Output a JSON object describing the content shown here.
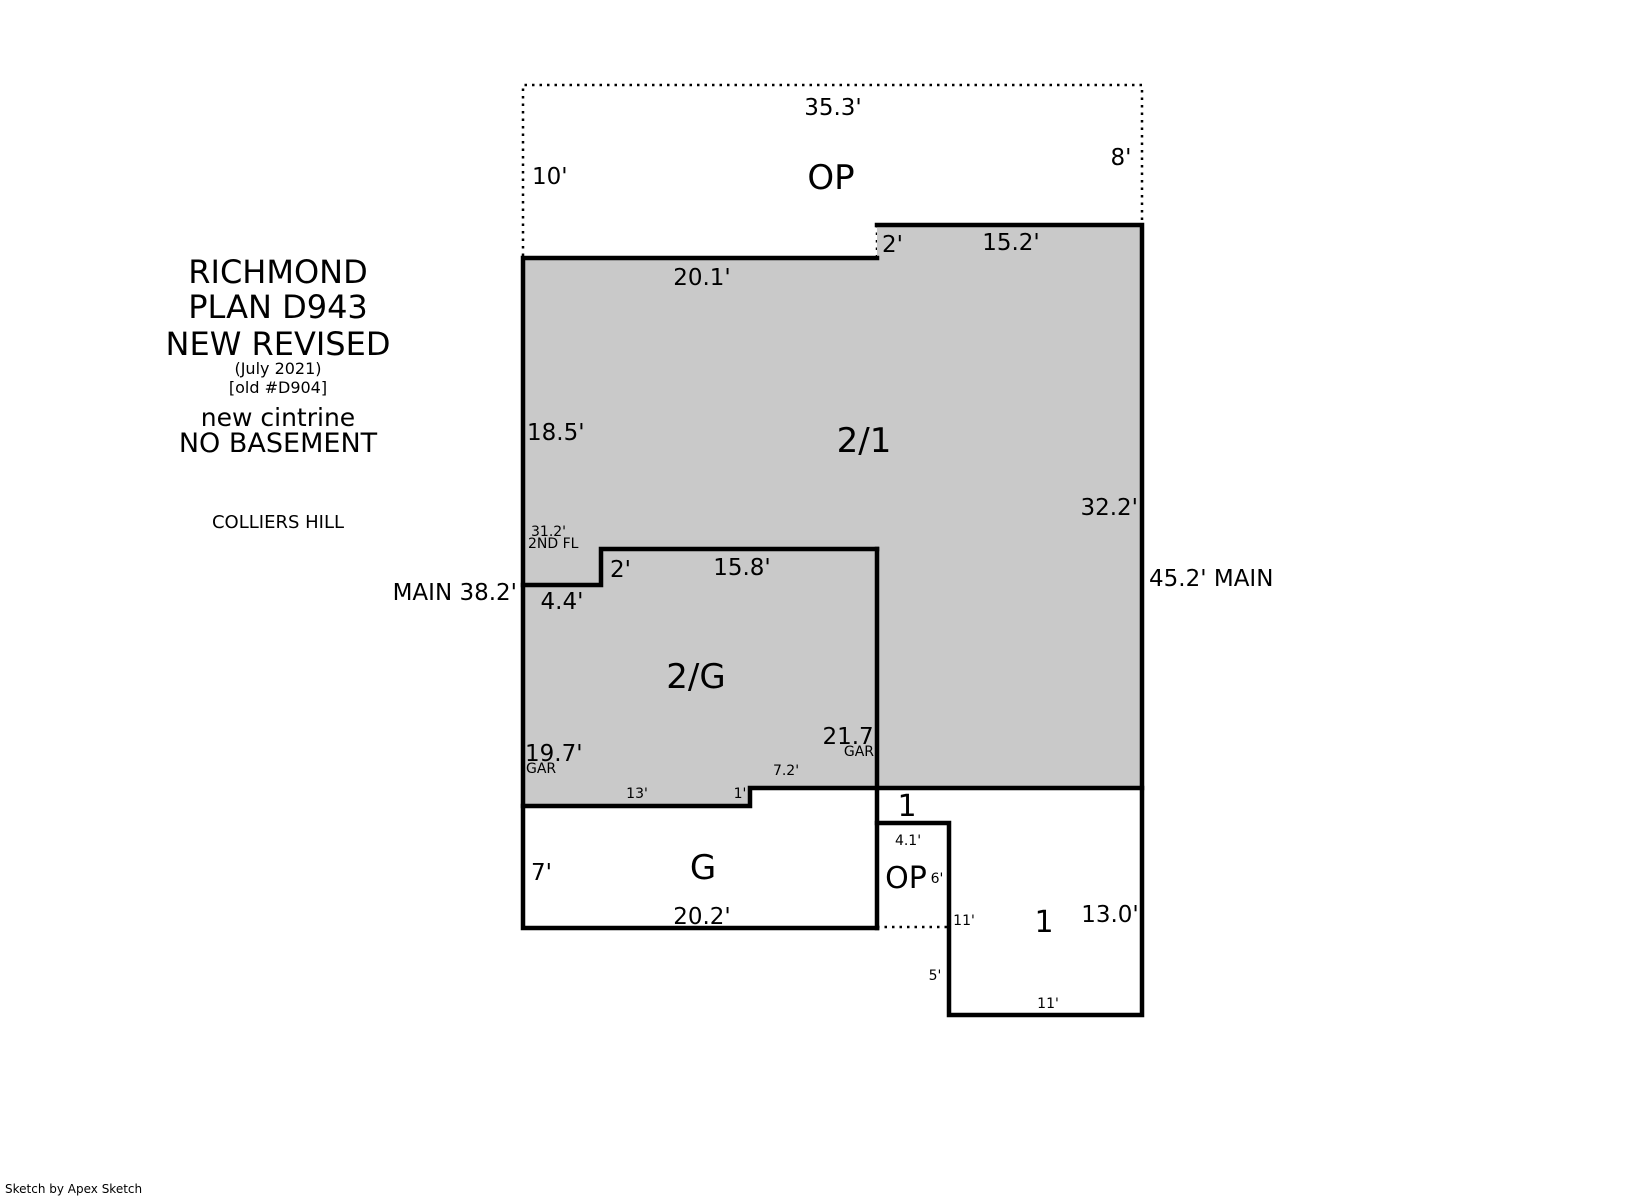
{
  "title_block": {
    "model": "RICHMOND",
    "plan": "PLAN D943",
    "revision": "NEW REVISED",
    "revision_date": "(July 2021)",
    "old_plan": "[old #D904]",
    "note1": "new cintrine",
    "note2": "NO BASEMENT",
    "subdivision": "COLLIERS HILL"
  },
  "area_labels": {
    "open_porch_top": "OP",
    "two_story_over_one": "2/1",
    "two_story_over_garage": "2/G",
    "garage": "G",
    "one_story_strip": "1",
    "open_porch_bottom": "OP",
    "one_story_room": "1"
  },
  "dimensions": {
    "op_top_width": "35.3'",
    "op_left_depth": "10'",
    "op_right_depth": "8'",
    "front_wall_left": "20.1'",
    "front_wall_step": "2'",
    "front_wall_right": "15.2'",
    "left_wall_upper": "18.5'",
    "left_wall_2nd_fl": "31.2'",
    "left_wall_2nd_fl_note": "2ND FL",
    "left_wall_main": "MAIN 38.2'",
    "garage_step_in": "4.4'",
    "garage_step_up": "2'",
    "garage_top_width": "15.8'",
    "right_wall_upper": "32.2'",
    "right_wall_main": "45.2' MAIN",
    "garage_left_depth": "19.7'",
    "garage_left_note": "GAR",
    "garage_right_depth": "21.7'",
    "garage_right_note": "GAR",
    "garage_bottom_left": "13'",
    "garage_bottom_step": "1'",
    "garage_bottom_right": "7.2'",
    "garage_front_left": "7'",
    "garage_front_width": "20.2'",
    "op_bottom_width": "4.1'",
    "op_bottom_right_depth": "6'",
    "room1_width": "11'",
    "room1_left_depth": "5'",
    "room1_bottom_width": "11'",
    "right_wall_lower": "13.0'"
  },
  "footer": {
    "credit": "Sketch by Apex Sketch"
  },
  "colors": {
    "two_story_fill": "#c9c9c9",
    "wall": "#000000",
    "background": "#ffffff"
  }
}
